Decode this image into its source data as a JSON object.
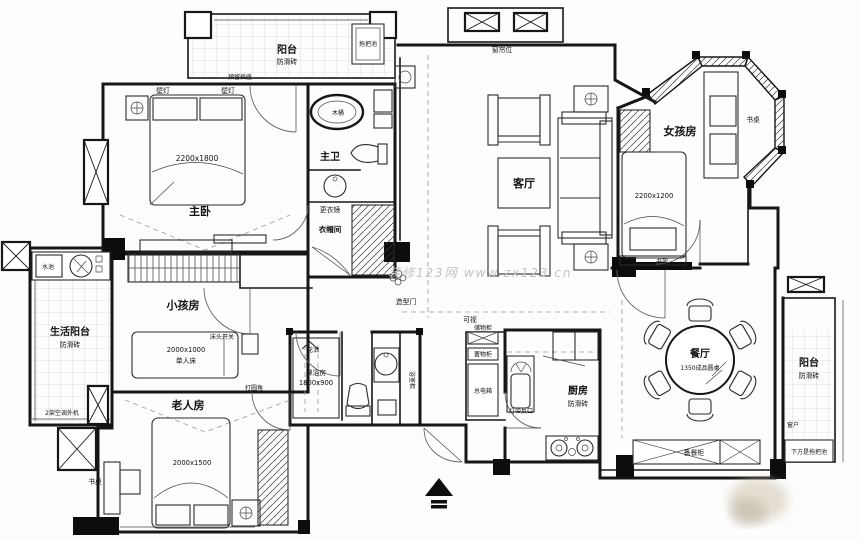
{
  "watermark": "装修123网 www.zx123.cn",
  "balcony_top": {
    "name": "阳台",
    "tile": "防滑砖",
    "mop": "拖把池",
    "socket": "预留插座"
  },
  "master_bedroom": {
    "name": "主卧",
    "bed_size": "2200x1800",
    "lamp_left": "壁灯",
    "lamp_right": "壁灯"
  },
  "master_bath": {
    "name": "主卫",
    "tub": "木桶"
  },
  "cloakroom": {
    "mirror": "更衣镜",
    "name": "衣帽间"
  },
  "living_room": {
    "name": "客厅",
    "curtain": "窗帘位"
  },
  "girls_room": {
    "name": "女孩房",
    "bed_size": "2200x1200",
    "desk": "书桌",
    "shelf": "书架"
  },
  "kids_room": {
    "name": "小孩房",
    "bed_size": "2000x1000",
    "bed_type": "单人床",
    "switch": "床头开关",
    "corner": "打圆角"
  },
  "life_balcony": {
    "name": "生活阳台",
    "tile": "防滑砖",
    "sink": "水池",
    "ac": "2架空调外机"
  },
  "elder_room": {
    "name": "老人房",
    "bed_size": "2000x1500",
    "desk": "书桌"
  },
  "bathroom": {
    "shower": "淋浴房",
    "shower_size": "1800x900",
    "shower_head": "花洒",
    "cabinet": "浴室柜"
  },
  "kitchen": {
    "name": "厨房",
    "tile": "防滑砖",
    "light": "灯带反口"
  },
  "dining_room": {
    "name": "餐厅",
    "table": "1350成品圆桌",
    "cabinet": "备餐柜"
  },
  "balcony_right": {
    "name": "阳台",
    "tile": "防滑砖",
    "window": "窗户",
    "mop": "下方是拖把池"
  },
  "entry": {
    "intercom": "可视",
    "box1": "储物柜",
    "box2": "置物柜",
    "power": "总电箱",
    "door": "造型门"
  }
}
